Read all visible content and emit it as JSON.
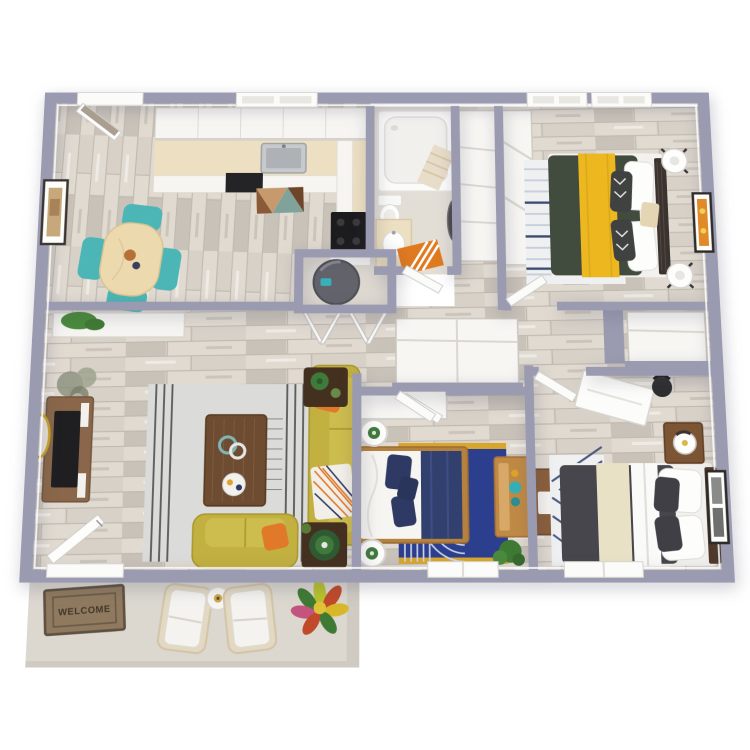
{
  "image": {
    "kind": "3d-rendered-apartment-floor-plan",
    "background": "#ffffff",
    "rooms_count": 8
  },
  "colors": {
    "wall": "#9a9bb1",
    "floor_wood": "#d7d1c8",
    "plank_light": "#e0dad1",
    "plank_dark": "#c9c2b9",
    "white_surface": "#f6f5f2",
    "counter_beige": "#ecdfc2",
    "appliance_black": "#242426",
    "steel": "#c7cacd",
    "teal": "#4cb5b5",
    "table_wood": "#ecd9ae",
    "sofa_mustard": "#c2b040",
    "pillow_orange": "#e0792a",
    "rug_gray": "#dbdbd9",
    "coffee_table_brown": "#6e4c32",
    "console_brown": "#8a674a",
    "bed_green": "#414b3e",
    "runner_yellow": "#ecb71f",
    "stripe_navy": "#3c4c6e",
    "rug_blue": "#2c3f8e",
    "rug_gold": "#d8a62c",
    "bed_navy": "#2e3a64",
    "frame_oak": "#b5813f",
    "dresser_oak": "#c08a45",
    "bed_charcoal": "#46464c",
    "runner_cream": "#e9e1c6",
    "nightstand_brown": "#7c5534",
    "mat_orange": "#e07a20",
    "welcome_brown": "#8f7a5f",
    "patio_concrete": "#dcd8d0",
    "plant_green": "#3f7a3c",
    "water_heater": "#63636b",
    "mirror_gold": "#c9a227",
    "art_orange": "#e08a2a",
    "bath_floor": "#e2ddd5",
    "door_taupe": "#a99e90"
  },
  "rooms": [
    {
      "id": "kitchen-dining",
      "furniture": [
        "upper-cabinets",
        "window-over-sink",
        "countertop",
        "stainless-sink",
        "dishwasher",
        "black-range",
        "geometric-kitchen-rug",
        "dining-table",
        "teal-chair x4",
        "wall-art",
        "back-door"
      ]
    },
    {
      "id": "bathroom",
      "furniture": [
        "bathtub",
        "toilet",
        "vanity-sink",
        "orange-striped-mat",
        "round-mirror"
      ]
    },
    {
      "id": "utility-closet",
      "furniture": [
        "water-heater",
        "bifold-doors"
      ]
    },
    {
      "id": "bedroom-1",
      "furniture": [
        "green-yellow-bed",
        "striped-rug",
        "tripod-lamp x2",
        "wall-art",
        "closet",
        "window x2"
      ]
    },
    {
      "id": "hallway",
      "furniture": [
        "linen-closet",
        "bedroom-closet"
      ]
    },
    {
      "id": "living-room",
      "furniture": [
        "tv-console",
        "tv",
        "gold-round-mirror",
        "tall-plant",
        "planter-half-wall",
        "gray-area-rug",
        "coffee-table",
        "mustard-sofa",
        "mustard-loveseat",
        "orange-pillow x2",
        "throw-blanket",
        "end-table-with-plant x2",
        "entry-door"
      ]
    },
    {
      "id": "bedroom-2",
      "furniture": [
        "white-navy-bed",
        "blue-arch-rug",
        "round-side-table x2",
        "oak-dresser",
        "closet",
        "plant",
        "window"
      ]
    },
    {
      "id": "bedroom-3",
      "furniture": [
        "charcoal-cream-bed",
        "chevron-rug",
        "nightstand-lamp",
        "white-desk",
        "desk-chair",
        "wood-side-table",
        "wall-art",
        "window"
      ]
    },
    {
      "id": "patio",
      "furniture": [
        "welcome-mat",
        "patio-armchair x2",
        "round-side-table",
        "croton-plant"
      ]
    }
  ],
  "patio": {
    "welcome_mat": {
      "text": "WELCOME"
    }
  }
}
